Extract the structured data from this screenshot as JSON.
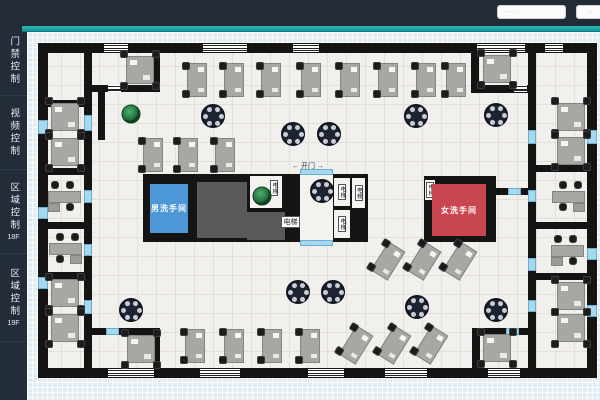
{
  "topbar": {
    "search_text": "· · · · ·",
    "button_text": "· ·",
    "bg": "#232b38",
    "accent": "#1ba5a4"
  },
  "sidebar": {
    "items": [
      {
        "label": "门禁控制",
        "sub": ""
      },
      {
        "label": "视频控制",
        "sub": ""
      },
      {
        "label": "区域控制",
        "sub": "18F"
      },
      {
        "label": "区域控制",
        "sub": "19F"
      }
    ]
  },
  "plan": {
    "colors": {
      "wall": "#141414",
      "floor": "#f1f0ec",
      "door": "#a6d9ee",
      "core": "#5a5a5a",
      "men_room": "#4e97d6",
      "women_room": "#c9454f"
    },
    "walls": [
      [
        38,
        43,
        559,
        10
      ],
      [
        38,
        368,
        559,
        10
      ],
      [
        38,
        43,
        10,
        335
      ],
      [
        587,
        43,
        10,
        335
      ],
      [
        84,
        53,
        8,
        315
      ],
      [
        48,
        100,
        36,
        7
      ],
      [
        48,
        168,
        36,
        7
      ],
      [
        48,
        222,
        36,
        7
      ],
      [
        48,
        272,
        36,
        7
      ],
      [
        153,
        43,
        7,
        49
      ],
      [
        84,
        85,
        76,
        7
      ],
      [
        98,
        92,
        7,
        48
      ],
      [
        84,
        328,
        76,
        7
      ],
      [
        153,
        328,
        7,
        47
      ],
      [
        471,
        43,
        8,
        50
      ],
      [
        471,
        85,
        65,
        8
      ],
      [
        528,
        53,
        8,
        315
      ],
      [
        536,
        165,
        51,
        7
      ],
      [
        536,
        222,
        51,
        7
      ],
      [
        536,
        273,
        51,
        7
      ],
      [
        472,
        328,
        64,
        7
      ],
      [
        472,
        328,
        8,
        47
      ],
      [
        143,
        174,
        225,
        68
      ],
      [
        424,
        176,
        72,
        66
      ],
      [
        494,
        188,
        42,
        7
      ]
    ],
    "windows": [
      [
        104,
        44,
        24,
        8
      ],
      [
        203,
        44,
        44,
        8
      ],
      [
        293,
        44,
        26,
        8
      ],
      [
        477,
        44,
        48,
        8
      ],
      [
        545,
        44,
        18,
        8
      ],
      [
        108,
        369,
        46,
        8
      ],
      [
        200,
        369,
        40,
        8
      ],
      [
        308,
        369,
        36,
        8
      ],
      [
        385,
        369,
        42,
        8
      ],
      [
        488,
        369,
        32,
        8
      ],
      [
        108,
        85,
        13,
        7
      ],
      [
        514,
        85,
        13,
        7
      ]
    ],
    "doors": [
      [
        84,
        115,
        8,
        16
      ],
      [
        84,
        190,
        8,
        13
      ],
      [
        84,
        244,
        8,
        12
      ],
      [
        84,
        300,
        8,
        14
      ],
      [
        528,
        130,
        8,
        14
      ],
      [
        528,
        190,
        8,
        12
      ],
      [
        528,
        258,
        8,
        13
      ],
      [
        528,
        300,
        8,
        12
      ],
      [
        38,
        120,
        10,
        14
      ],
      [
        38,
        207,
        10,
        12
      ],
      [
        38,
        277,
        10,
        12
      ],
      [
        587,
        130,
        10,
        14
      ],
      [
        587,
        248,
        10,
        12
      ],
      [
        587,
        305,
        10,
        12
      ],
      [
        106,
        328,
        13,
        7
      ],
      [
        506,
        328,
        13,
        7
      ],
      [
        300,
        169,
        33,
        6
      ],
      [
        300,
        240,
        33,
        6
      ],
      [
        508,
        188,
        13,
        7
      ],
      [
        224,
        88,
        12,
        6
      ]
    ],
    "blocks": [
      [
        197,
        182,
        50,
        56
      ],
      [
        247,
        212,
        38,
        28
      ]
    ],
    "shafts": [
      {
        "x": 250,
        "y": 176,
        "w": 32,
        "h": 32,
        "label": ""
      },
      {
        "x": 300,
        "y": 175,
        "w": 33,
        "h": 65,
        "label": ""
      },
      {
        "x": 268,
        "y": 178,
        "w": 12,
        "h": 20,
        "label": "电梯"
      },
      {
        "x": 334,
        "y": 178,
        "w": 16,
        "h": 28,
        "label": "电梯"
      },
      {
        "x": 334,
        "y": 210,
        "w": 16,
        "h": 28,
        "label": "电梯"
      },
      {
        "x": 352,
        "y": 178,
        "w": 13,
        "h": 30,
        "label": "电梯"
      },
      {
        "x": 425,
        "y": 180,
        "w": 10,
        "h": 20,
        "label": "电梯"
      }
    ],
    "rooms": [
      {
        "x": 150,
        "y": 184,
        "w": 38,
        "h": 49,
        "bg": "#4e97d6",
        "fg": "#ffffff",
        "label": "男洗手间",
        "name": "mens-restroom"
      },
      {
        "x": 432,
        "y": 184,
        "w": 54,
        "h": 52,
        "bg": "#c9454f",
        "fg": "#ffffff",
        "label": "女洗手间",
        "name": "womens-restroom"
      }
    ],
    "labels": [
      {
        "text": "← 开门 →",
        "x": 292,
        "y": 161,
        "fs": 7,
        "box": false,
        "name": "door-open-control"
      },
      {
        "text": "电梯",
        "x": 281,
        "y": 216,
        "w": 19,
        "h": 12,
        "fs": 7,
        "box": true,
        "name": "elevator-label"
      }
    ],
    "desks_quad": [
      [
        140,
        70
      ],
      [
        497,
        69
      ],
      [
        65,
        117
      ],
      [
        65,
        152
      ],
      [
        65,
        293
      ],
      [
        65,
        328
      ],
      [
        571,
        117
      ],
      [
        571,
        151
      ],
      [
        571,
        296
      ],
      [
        571,
        328
      ],
      [
        141,
        349
      ],
      [
        497,
        348
      ]
    ],
    "desks_exec": [
      {
        "c": [
          65,
          196
        ],
        "flip": false
      },
      {
        "c": [
          65,
          248
        ],
        "flip": true
      },
      {
        "c": [
          568,
          196
        ],
        "flip": true
      },
      {
        "c": [
          568,
          250
        ],
        "flip": false
      }
    ],
    "desks_v": [
      [
        187,
        63
      ],
      [
        224,
        63
      ],
      [
        261,
        63
      ],
      [
        301,
        63
      ],
      [
        340,
        63
      ],
      [
        378,
        63
      ],
      [
        416,
        63
      ],
      [
        446,
        63
      ],
      [
        143,
        138
      ],
      [
        178,
        138
      ],
      [
        215,
        138
      ],
      [
        185,
        329
      ],
      [
        224,
        329
      ],
      [
        262,
        329
      ],
      [
        300,
        329
      ]
    ],
    "desks_tilted": [
      [
        388,
        261
      ],
      [
        424,
        261
      ],
      [
        460,
        261
      ],
      [
        356,
        345
      ],
      [
        394,
        345
      ],
      [
        431,
        345
      ]
    ],
    "round_tables": [
      [
        213,
        116
      ],
      [
        293,
        134
      ],
      [
        329,
        134
      ],
      [
        416,
        116
      ],
      [
        496,
        115
      ],
      [
        131,
        310
      ],
      [
        298,
        292
      ],
      [
        333,
        292
      ],
      [
        417,
        307
      ],
      [
        496,
        310
      ],
      [
        322,
        191
      ]
    ],
    "plants": [
      [
        131,
        114
      ],
      [
        262,
        196
      ]
    ]
  }
}
